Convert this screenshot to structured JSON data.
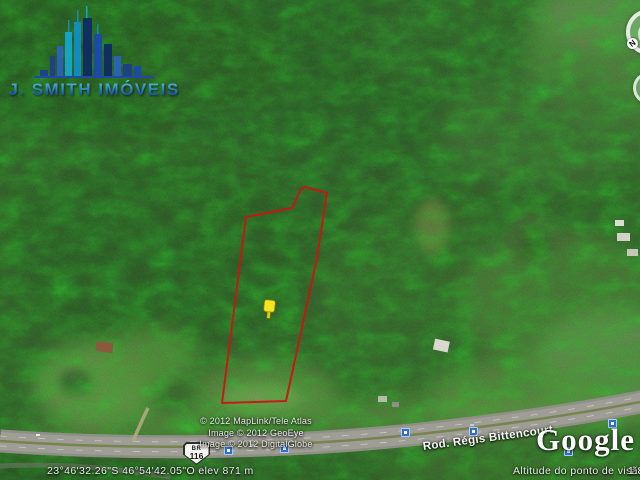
{
  "watermark": {
    "brand_line": "J. SMITH IMÓVEIS"
  },
  "overlay": {
    "polygon_points": "246,217 292,208 301,189 305,187 327,193 317,258 286,401 222,403",
    "polygon_color": "#cb1512",
    "pushpin_color": "#f2e41f"
  },
  "map_labels": {
    "road_shield": {
      "prefix": "BR",
      "number": "116"
    },
    "road_name": "Rod. Régis Bittencourt"
  },
  "attribution": {
    "line1": "© 2012 MapLink/Tele Atlas",
    "line2": "Image © 2012 GeoEye",
    "line3": "Image © 2012 DigitalGlobe"
  },
  "branding": {
    "google_logo": "Google ea"
  },
  "status_bar": {
    "coordinates": "23°46'32.26\"S   46°54'42.05\"O   elev   871 m",
    "altitude_label": "Altitude do ponto de visão",
    "altitude_value": "1.8"
  },
  "navigation": {
    "north_label": "N"
  },
  "icon_colors": {
    "photo_icon": "#2f6fd0"
  }
}
